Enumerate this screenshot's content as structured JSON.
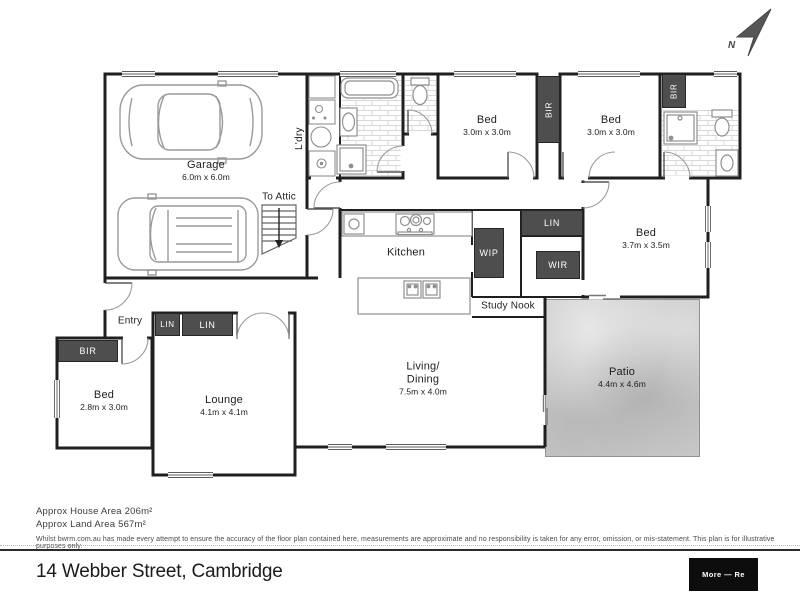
{
  "colors": {
    "wall": "#1f1f1f",
    "closet": "#4e4e4e",
    "patio": "#c9c9c9"
  },
  "compass": {
    "label": "N"
  },
  "rooms": {
    "garage": {
      "name": "Garage",
      "dims": "6.0m x 6.0m"
    },
    "laundry": {
      "name": "L'dry"
    },
    "attic": {
      "name": "To Attic"
    },
    "bed_top_left": {
      "name": "Bed",
      "dims": "3.0m x 3.0m"
    },
    "bed_top_right": {
      "name": "Bed",
      "dims": "3.0m x 3.0m"
    },
    "bed_master": {
      "name": "Bed",
      "dims": "3.7m x 3.5m"
    },
    "bed_front": {
      "name": "Bed",
      "dims": "2.8m x 3.0m"
    },
    "kitchen": {
      "name": "Kitchen"
    },
    "study_nook": {
      "name": "Study Nook"
    },
    "living_dining": {
      "name_line1": "Living/",
      "name_line2": "Dining",
      "dims": "7.5m x 4.0m"
    },
    "lounge": {
      "name": "Lounge",
      "dims": "4.1m x 4.1m"
    },
    "patio": {
      "name": "Patio",
      "dims": "4.4m x 4.6m"
    },
    "entry": {
      "name": "Entry"
    }
  },
  "closets": {
    "bir_top_left": "BIR",
    "bir_top_right": "BIR",
    "bir_front": "BIR",
    "lin_kitchen": "LIN",
    "lin_hall_1": "LIN",
    "lin_hall_2": "LIN",
    "wip": "WIP",
    "wir": "WIR"
  },
  "footer": {
    "house_area": "Approx House Area 206m²",
    "land_area": "Approx Land Area 567m²",
    "disclaimer": "Whilst bwrm.com.au has made every attempt to ensure the accuracy of the floor plan contained here, measurements are approximate and no responsibility is taken for any error, omission, or mis-statement. This plan is for illustrative purposes only.",
    "address": "14 Webber Street, Cambridge",
    "brand": "More — Re"
  }
}
